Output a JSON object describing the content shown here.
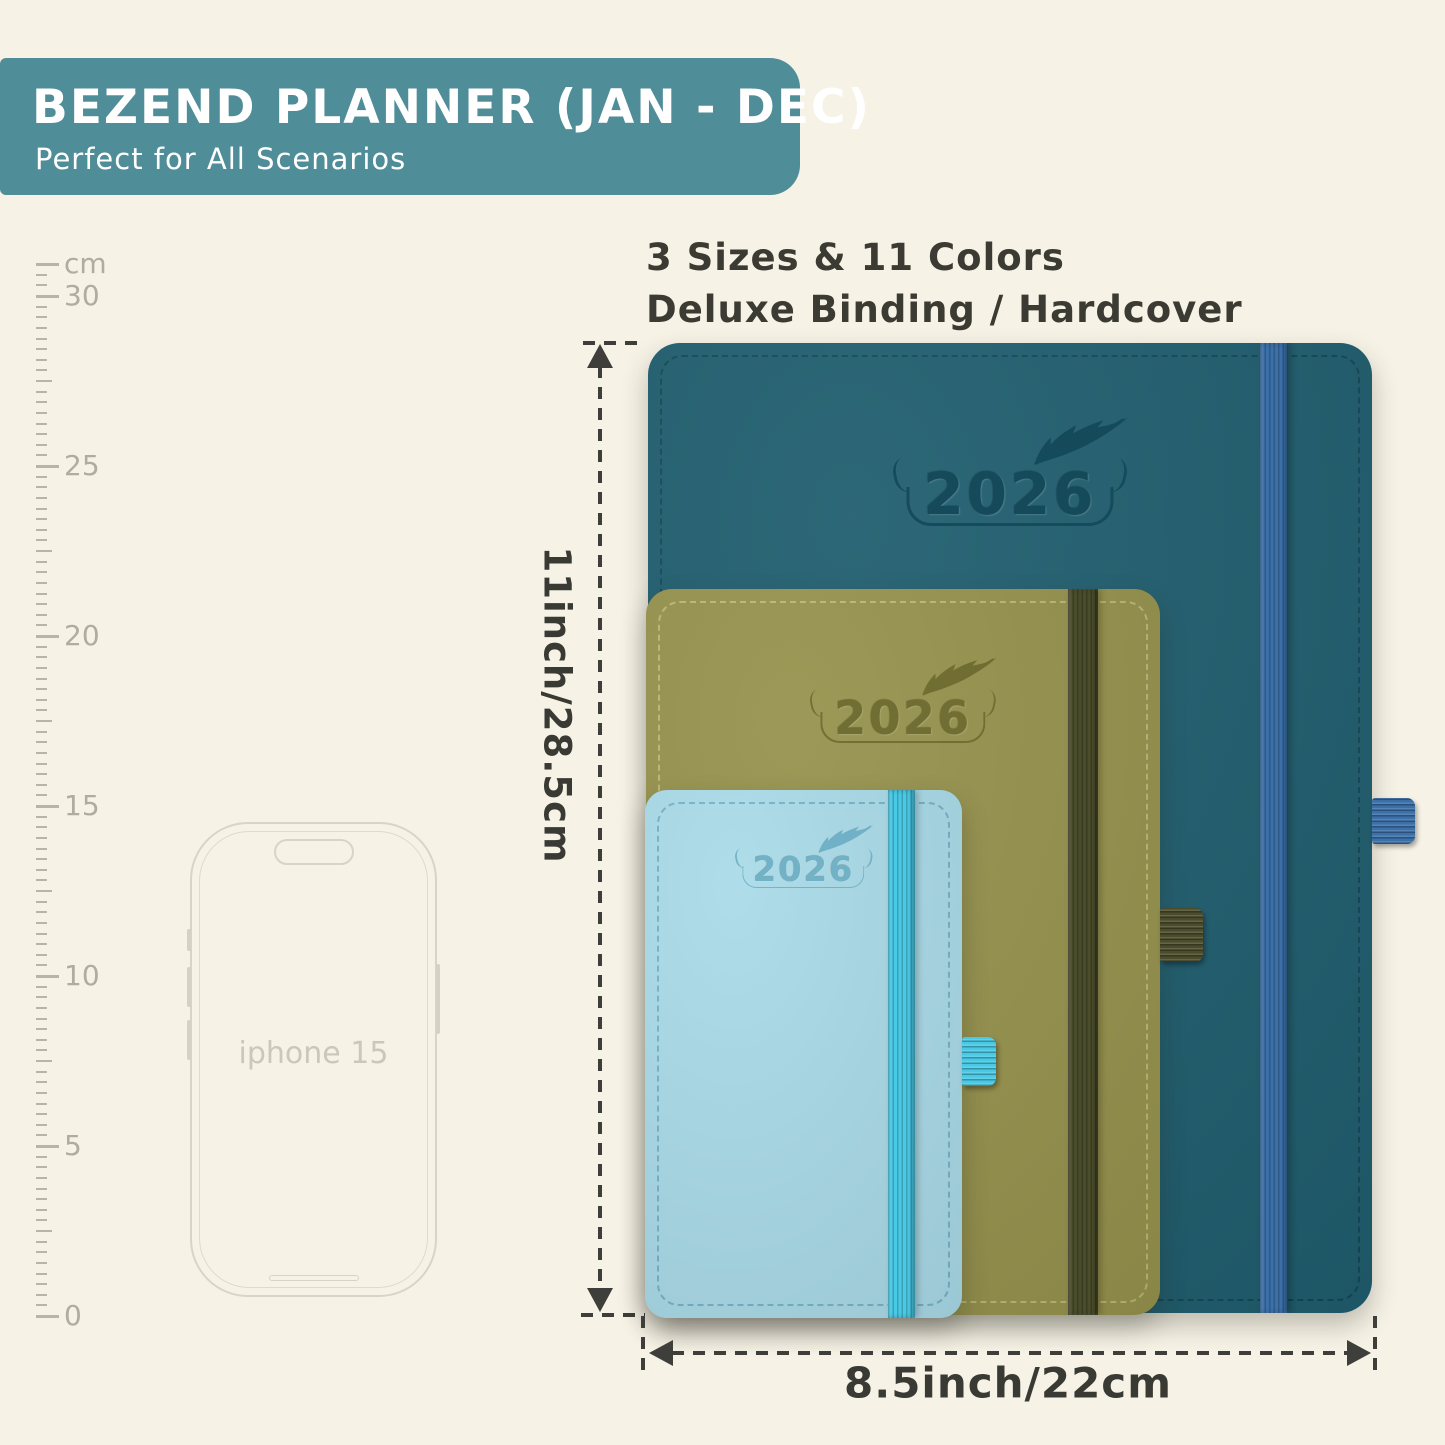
{
  "banner": {
    "title": "BEZEND PLANNER (JAN - DEC)",
    "subtitle": "Perfect for All Scenarios",
    "bg_color": "#4f8d98",
    "text_color": "#ffffff"
  },
  "headline": {
    "line1": "3 Sizes & 11 Colors",
    "line2": "Deluxe Binding / Hardcover",
    "text_color": "#3b3b33"
  },
  "ruler": {
    "unit_label": "cm",
    "major_labels": [
      "0",
      "5",
      "10",
      "15",
      "20",
      "25",
      "30"
    ],
    "tick_color": "#b8b4a7",
    "label_color": "#b0ac9f"
  },
  "phone": {
    "label": "iphone 15",
    "outline_color": "#d8d4c7",
    "label_color": "#cbc7b9"
  },
  "size_annotations": {
    "height_label": "11inch/28.5cm",
    "width_label": "8.5inch/22cm",
    "line_color": "#3e3e3a",
    "text_color": "#3a3a35"
  },
  "planners": [
    {
      "id": "large",
      "year": "2026",
      "cover_color": "#1d5c6d",
      "band_color": "#3b70a9",
      "loop_color": "#3b70a9",
      "emboss_color": "#14495a",
      "stitch_color": "rgba(9,48,61,0.65)"
    },
    {
      "id": "medium",
      "year": "2026",
      "cover_color": "#95914b",
      "band_color": "#4a4c2b",
      "loop_color": "#4a4c2b",
      "emboss_color": "#6f6c32",
      "stitch_color": "rgba(222,216,150,0.70)"
    },
    {
      "id": "small",
      "year": "2026",
      "cover_color": "#a9dae8",
      "band_color": "#49c9e5",
      "loop_color": "#49c9e5",
      "emboss_color": "#6fb0c6",
      "stitch_color": "rgba(35,115,145,0.50)"
    }
  ],
  "palette": {
    "background": "#f6f2e6"
  }
}
